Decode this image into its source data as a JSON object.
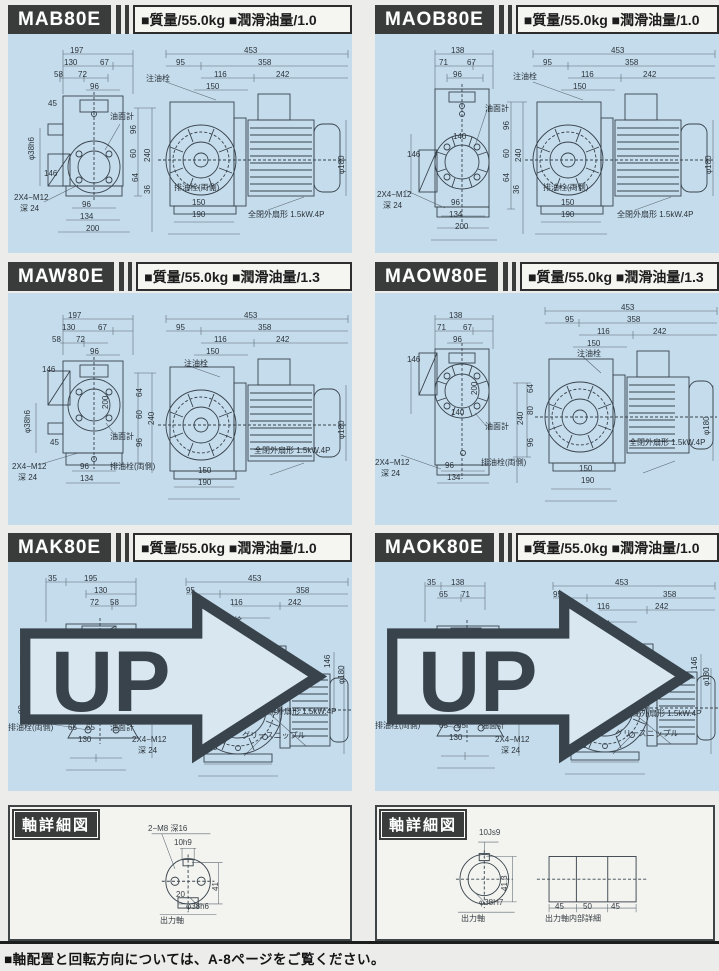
{
  "colors": {
    "panel_bg": "#c4dcec",
    "header_bg": "#3a3c3b",
    "page_bg": "#ecedea",
    "line": "#39434c"
  },
  "page": {
    "footer": "■軸配置と回転方向については、A-8ページをご覧ください。"
  },
  "panels": [
    {
      "model": "MAB80E",
      "spec": "■質量/55.0kg ■潤滑油量/1.0",
      "up": false,
      "labels": [
        {
          "t": "197",
          "x": 62,
          "y": 13
        },
        {
          "t": "130",
          "x": 56,
          "y": 25
        },
        {
          "t": "67",
          "x": 92,
          "y": 25
        },
        {
          "t": "58",
          "x": 46,
          "y": 37
        },
        {
          "t": "72",
          "x": 70,
          "y": 37
        },
        {
          "t": "96",
          "x": 82,
          "y": 49
        },
        {
          "t": "注油栓",
          "x": 138,
          "y": 41
        },
        {
          "t": "45",
          "x": 40,
          "y": 66
        },
        {
          "t": "油面計",
          "x": 102,
          "y": 79
        },
        {
          "t": "φ38h6",
          "x": 20,
          "y": 126,
          "v": 1
        },
        {
          "t": "146",
          "x": 36,
          "y": 136
        },
        {
          "t": "2X4−M12",
          "x": 6,
          "y": 160
        },
        {
          "t": "深 24",
          "x": 12,
          "y": 171
        },
        {
          "t": "96",
          "x": 74,
          "y": 167
        },
        {
          "t": "134",
          "x": 72,
          "y": 179
        },
        {
          "t": "200",
          "x": 78,
          "y": 191
        },
        {
          "t": "96",
          "x": 122,
          "y": 100,
          "v": 1
        },
        {
          "t": "240",
          "x": 136,
          "y": 128,
          "v": 1
        },
        {
          "t": "60",
          "x": 122,
          "y": 124,
          "v": 1
        },
        {
          "t": "64",
          "x": 124,
          "y": 148,
          "v": 1
        },
        {
          "t": "36",
          "x": 136,
          "y": 160,
          "v": 1
        },
        {
          "t": "453",
          "x": 236,
          "y": 13
        },
        {
          "t": "95",
          "x": 168,
          "y": 25
        },
        {
          "t": "358",
          "x": 250,
          "y": 25
        },
        {
          "t": "116",
          "x": 206,
          "y": 37
        },
        {
          "t": "242",
          "x": 268,
          "y": 37
        },
        {
          "t": "150",
          "x": 198,
          "y": 49
        },
        {
          "t": "φ180",
          "x": 330,
          "y": 140,
          "v": 1
        },
        {
          "t": "排油栓(両側)",
          "x": 166,
          "y": 150
        },
        {
          "t": "150",
          "x": 184,
          "y": 165
        },
        {
          "t": "190",
          "x": 184,
          "y": 177
        },
        {
          "t": "全閉外扇形  1.5kW.4P",
          "x": 240,
          "y": 177
        }
      ]
    },
    {
      "model": "MAOB80E",
      "spec": "■質量/55.0kg ■潤滑油量/1.0",
      "up": false,
      "labels": [
        {
          "t": "138",
          "x": 76,
          "y": 13
        },
        {
          "t": "71",
          "x": 64,
          "y": 25
        },
        {
          "t": "67",
          "x": 92,
          "y": 25
        },
        {
          "t": "96",
          "x": 78,
          "y": 37
        },
        {
          "t": "注油栓",
          "x": 138,
          "y": 39
        },
        {
          "t": "油面計",
          "x": 110,
          "y": 71
        },
        {
          "t": "140",
          "x": 78,
          "y": 99
        },
        {
          "t": "146",
          "x": 32,
          "y": 117
        },
        {
          "t": "2X4−M12",
          "x": 2,
          "y": 157
        },
        {
          "t": "深 24",
          "x": 8,
          "y": 168
        },
        {
          "t": "96",
          "x": 76,
          "y": 165
        },
        {
          "t": "134",
          "x": 74,
          "y": 177
        },
        {
          "t": "200",
          "x": 80,
          "y": 189
        },
        {
          "t": "96",
          "x": 128,
          "y": 96,
          "v": 1
        },
        {
          "t": "240",
          "x": 140,
          "y": 128,
          "v": 1
        },
        {
          "t": "60",
          "x": 128,
          "y": 124,
          "v": 1
        },
        {
          "t": "64",
          "x": 128,
          "y": 148,
          "v": 1
        },
        {
          "t": "36",
          "x": 138,
          "y": 160,
          "v": 1
        },
        {
          "t": "453",
          "x": 236,
          "y": 13
        },
        {
          "t": "95",
          "x": 168,
          "y": 25
        },
        {
          "t": "358",
          "x": 250,
          "y": 25
        },
        {
          "t": "116",
          "x": 206,
          "y": 37
        },
        {
          "t": "242",
          "x": 268,
          "y": 37
        },
        {
          "t": "150",
          "x": 198,
          "y": 49
        },
        {
          "t": "φ180",
          "x": 330,
          "y": 140,
          "v": 1
        },
        {
          "t": "排油栓(両側)",
          "x": 168,
          "y": 150
        },
        {
          "t": "150",
          "x": 186,
          "y": 165
        },
        {
          "t": "190",
          "x": 186,
          "y": 177
        },
        {
          "t": "全閉外扇形  1.5kW.4P",
          "x": 242,
          "y": 177
        }
      ]
    },
    {
      "model": "MAW80E",
      "spec": "■質量/55.0kg ■潤滑油量/1.3",
      "up": false,
      "labels": [
        {
          "t": "197",
          "x": 60,
          "y": 19
        },
        {
          "t": "130",
          "x": 54,
          "y": 31
        },
        {
          "t": "67",
          "x": 90,
          "y": 31
        },
        {
          "t": "58",
          "x": 44,
          "y": 43
        },
        {
          "t": "72",
          "x": 68,
          "y": 43
        },
        {
          "t": "96",
          "x": 82,
          "y": 55
        },
        {
          "t": "146",
          "x": 34,
          "y": 73
        },
        {
          "t": "φ38h6",
          "x": 16,
          "y": 140,
          "v": 1
        },
        {
          "t": "45",
          "x": 42,
          "y": 146
        },
        {
          "t": "200",
          "x": 94,
          "y": 116,
          "v": 1
        },
        {
          "t": "油面計",
          "x": 102,
          "y": 140
        },
        {
          "t": "2X4−M12",
          "x": 4,
          "y": 170
        },
        {
          "t": "深 24",
          "x": 10,
          "y": 181
        },
        {
          "t": "96",
          "x": 72,
          "y": 170
        },
        {
          "t": "134",
          "x": 72,
          "y": 182
        },
        {
          "t": "排油栓(両側)",
          "x": 102,
          "y": 170
        },
        {
          "t": "64",
          "x": 128,
          "y": 104,
          "v": 1
        },
        {
          "t": "60",
          "x": 128,
          "y": 126,
          "v": 1
        },
        {
          "t": "96",
          "x": 128,
          "y": 154,
          "v": 1
        },
        {
          "t": "240",
          "x": 140,
          "y": 132,
          "v": 1
        },
        {
          "t": "453",
          "x": 236,
          "y": 19
        },
        {
          "t": "95",
          "x": 168,
          "y": 31
        },
        {
          "t": "358",
          "x": 250,
          "y": 31
        },
        {
          "t": "116",
          "x": 206,
          "y": 43
        },
        {
          "t": "242",
          "x": 268,
          "y": 43
        },
        {
          "t": "150",
          "x": 198,
          "y": 55
        },
        {
          "t": "注油栓",
          "x": 176,
          "y": 67
        },
        {
          "t": "φ180",
          "x": 330,
          "y": 146,
          "v": 1
        },
        {
          "t": "全閉外扇形  1.5kW.4P",
          "x": 246,
          "y": 154
        },
        {
          "t": "150",
          "x": 190,
          "y": 174
        },
        {
          "t": "190",
          "x": 190,
          "y": 186
        }
      ]
    },
    {
      "model": "MAOW80E",
      "spec": "■質量/55.0kg ■潤滑油量/1.3",
      "up": false,
      "labels": [
        {
          "t": "138",
          "x": 74,
          "y": 19
        },
        {
          "t": "71",
          "x": 62,
          "y": 31
        },
        {
          "t": "67",
          "x": 88,
          "y": 31
        },
        {
          "t": "96",
          "x": 78,
          "y": 43
        },
        {
          "t": "146",
          "x": 32,
          "y": 63
        },
        {
          "t": "200",
          "x": 96,
          "y": 102,
          "v": 1
        },
        {
          "t": "140",
          "x": 76,
          "y": 116
        },
        {
          "t": "油面計",
          "x": 110,
          "y": 130
        },
        {
          "t": "2X4−M12",
          "x": 0,
          "y": 166
        },
        {
          "t": "深 24",
          "x": 6,
          "y": 177
        },
        {
          "t": "96",
          "x": 70,
          "y": 169
        },
        {
          "t": "134",
          "x": 72,
          "y": 181
        },
        {
          "t": "排油栓(両側)",
          "x": 106,
          "y": 166
        },
        {
          "t": "453",
          "x": 246,
          "y": 11
        },
        {
          "t": "95",
          "x": 190,
          "y": 23
        },
        {
          "t": "358",
          "x": 252,
          "y": 23
        },
        {
          "t": "116",
          "x": 222,
          "y": 35
        },
        {
          "t": "242",
          "x": 278,
          "y": 35
        },
        {
          "t": "150",
          "x": 212,
          "y": 47
        },
        {
          "t": "注油栓",
          "x": 202,
          "y": 57
        },
        {
          "t": "64",
          "x": 152,
          "y": 100,
          "v": 1
        },
        {
          "t": "80",
          "x": 152,
          "y": 122,
          "v": 1
        },
        {
          "t": "96",
          "x": 152,
          "y": 154,
          "v": 1
        },
        {
          "t": "240",
          "x": 142,
          "y": 132,
          "v": 1
        },
        {
          "t": "φ180",
          "x": 328,
          "y": 142,
          "v": 1
        },
        {
          "t": "全閉外扇形  1.5kW.4P",
          "x": 254,
          "y": 146
        },
        {
          "t": "150",
          "x": 204,
          "y": 172
        },
        {
          "t": "190",
          "x": 206,
          "y": 184
        }
      ]
    },
    {
      "model": "MAK80E",
      "spec": "■質量/55.0kg ■潤滑油量/1.0",
      "up": true,
      "labels": [
        {
          "t": "35",
          "x": 40,
          "y": 13
        },
        {
          "t": "195",
          "x": 76,
          "y": 13
        },
        {
          "t": "130",
          "x": 86,
          "y": 25
        },
        {
          "t": "72",
          "x": 82,
          "y": 37
        },
        {
          "t": "58",
          "x": 102,
          "y": 37
        },
        {
          "t": "66",
          "x": 12,
          "y": 102,
          "v": 1
        },
        {
          "t": "200",
          "x": 22,
          "y": 124,
          "v": 1
        },
        {
          "t": "80",
          "x": 12,
          "y": 128,
          "v": 1
        },
        {
          "t": "90",
          "x": 10,
          "y": 152,
          "v": 1
        },
        {
          "t": "φ38h6",
          "x": 114,
          "y": 130,
          "v": 1
        },
        {
          "t": "45",
          "x": 100,
          "y": 134
        },
        {
          "t": "排油栓(両側)",
          "x": 0,
          "y": 162
        },
        {
          "t": "65",
          "x": 60,
          "y": 162
        },
        {
          "t": "65",
          "x": 78,
          "y": 162
        },
        {
          "t": "130",
          "x": 70,
          "y": 174
        },
        {
          "t": "油面計",
          "x": 102,
          "y": 162
        },
        {
          "t": "244",
          "x": 136,
          "y": 132,
          "v": 1
        },
        {
          "t": "125",
          "x": 148,
          "y": 120,
          "v": 1
        },
        {
          "t": "90",
          "x": 142,
          "y": 148,
          "v": 1
        },
        {
          "t": "2X4−M12",
          "x": 124,
          "y": 174
        },
        {
          "t": "深 24",
          "x": 130,
          "y": 185
        },
        {
          "t": "453",
          "x": 240,
          "y": 13
        },
        {
          "t": "95",
          "x": 178,
          "y": 25
        },
        {
          "t": "358",
          "x": 288,
          "y": 25
        },
        {
          "t": "116",
          "x": 222,
          "y": 37
        },
        {
          "t": "242",
          "x": 280,
          "y": 37
        },
        {
          "t": "注油栓",
          "x": 210,
          "y": 55
        },
        {
          "t": "150",
          "x": 202,
          "y": 67
        },
        {
          "t": "146",
          "x": 316,
          "y": 106,
          "v": 1
        },
        {
          "t": "φ180",
          "x": 330,
          "y": 122,
          "v": 1
        },
        {
          "t": "全閉外扇形  1.5kW.4P",
          "x": 252,
          "y": 146
        },
        {
          "t": "150",
          "x": 194,
          "y": 170
        },
        {
          "t": "グリースニップル",
          "x": 234,
          "y": 170
        },
        {
          "t": "190",
          "x": 196,
          "y": 182
        }
      ]
    },
    {
      "model": "MAOK80E",
      "spec": "■質量/55.0kg ■潤滑油量/1.0",
      "up": true,
      "labels": [
        {
          "t": "35",
          "x": 52,
          "y": 17
        },
        {
          "t": "138",
          "x": 76,
          "y": 17
        },
        {
          "t": "65",
          "x": 64,
          "y": 29
        },
        {
          "t": "71",
          "x": 86,
          "y": 29
        },
        {
          "t": "66",
          "x": 22,
          "y": 102,
          "v": 1
        },
        {
          "t": "200",
          "x": 30,
          "y": 124,
          "v": 1
        },
        {
          "t": "80",
          "x": 22,
          "y": 130,
          "v": 1
        },
        {
          "t": "90",
          "x": 20,
          "y": 154,
          "v": 1
        },
        {
          "t": "140",
          "x": 68,
          "y": 116
        },
        {
          "t": "排油栓(両側)",
          "x": 0,
          "y": 160
        },
        {
          "t": "65",
          "x": 64,
          "y": 160
        },
        {
          "t": "65",
          "x": 82,
          "y": 160
        },
        {
          "t": "130",
          "x": 74,
          "y": 172
        },
        {
          "t": "油面計",
          "x": 106,
          "y": 160
        },
        {
          "t": "244",
          "x": 136,
          "y": 130,
          "v": 1
        },
        {
          "t": "125",
          "x": 148,
          "y": 118,
          "v": 1
        },
        {
          "t": "80",
          "x": 142,
          "y": 148,
          "v": 1
        },
        {
          "t": "2X4−M12",
          "x": 120,
          "y": 174
        },
        {
          "t": "深 24",
          "x": 126,
          "y": 185
        },
        {
          "t": "453",
          "x": 240,
          "y": 17
        },
        {
          "t": "95",
          "x": 178,
          "y": 29
        },
        {
          "t": "358",
          "x": 288,
          "y": 29
        },
        {
          "t": "116",
          "x": 222,
          "y": 41
        },
        {
          "t": "242",
          "x": 280,
          "y": 41
        },
        {
          "t": "注油栓",
          "x": 212,
          "y": 59
        },
        {
          "t": "150",
          "x": 204,
          "y": 71
        },
        {
          "t": "146",
          "x": 316,
          "y": 108,
          "v": 1
        },
        {
          "t": "φ180",
          "x": 328,
          "y": 124,
          "v": 1
        },
        {
          "t": "全閉外扇形  1.5kW.4P",
          "x": 250,
          "y": 148
        },
        {
          "t": "150",
          "x": 196,
          "y": 168
        },
        {
          "t": "グリースニップル",
          "x": 240,
          "y": 168
        },
        {
          "t": "190",
          "x": 198,
          "y": 180
        }
      ]
    }
  ],
  "shaft_panels": [
    {
      "title": "軸詳細図",
      "labels": [
        {
          "t": "2−M8  深16",
          "x": 138,
          "y": 18
        },
        {
          "t": "10h9",
          "x": 164,
          "y": 32
        },
        {
          "t": "41",
          "x": 202,
          "y": 84,
          "v": 1
        },
        {
          "t": "20",
          "x": 166,
          "y": 84
        },
        {
          "t": "φ38h6",
          "x": 176,
          "y": 96
        },
        {
          "t": "出力軸",
          "x": 150,
          "y": 110
        }
      ]
    },
    {
      "title": "軸詳細図",
      "labels": [
        {
          "t": "10Js9",
          "x": 102,
          "y": 22
        },
        {
          "t": "41.3",
          "x": 124,
          "y": 84,
          "v": 1
        },
        {
          "t": "φ38H7",
          "x": 102,
          "y": 92
        },
        {
          "t": "出力軸",
          "x": 84,
          "y": 108
        },
        {
          "t": "45",
          "x": 178,
          "y": 96
        },
        {
          "t": "50",
          "x": 206,
          "y": 96
        },
        {
          "t": "45",
          "x": 234,
          "y": 96
        },
        {
          "t": "出力軸内部詳細",
          "x": 168,
          "y": 108
        }
      ]
    }
  ],
  "up_badge": {
    "label": "UP"
  }
}
